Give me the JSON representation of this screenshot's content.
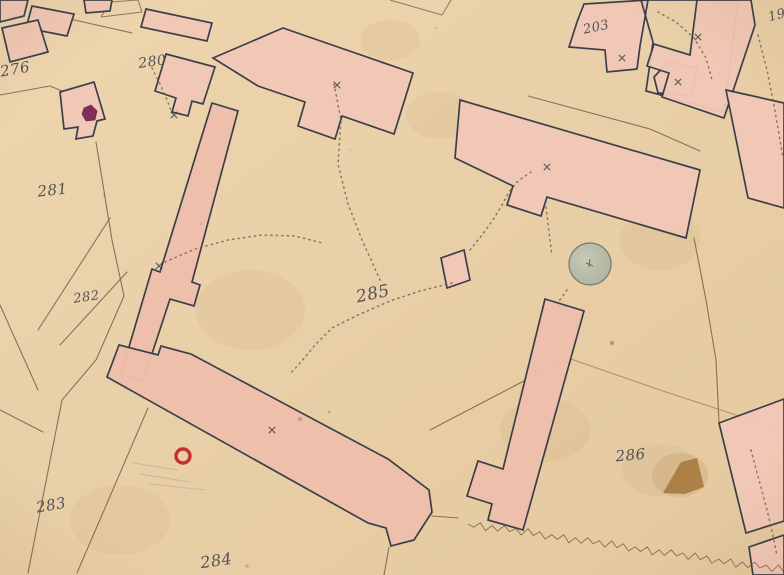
{
  "map": {
    "colors": {
      "paper": "#e9cfa7",
      "paper_light": "#eed7b2",
      "paper_dark": "#e3c69c",
      "building_fill": "#f2c8b6",
      "building_fill_alt": "#efc0ad",
      "building_stroke": "#343a47",
      "line": "#7b5f45",
      "red_line": "#bb7a66",
      "dotted": "#6f5741",
      "ink": "#43454e",
      "ring_red": "#c32222",
      "blob_crimson": "#7d2752",
      "well_fill": "#b9bdac",
      "well_stroke": "#70756a",
      "stain_brown": "#a5763a"
    },
    "region_labels": [
      {
        "name": "parcel-276",
        "text": "276",
        "x": 16,
        "y": 74,
        "size": 15,
        "rotate": -10
      },
      {
        "name": "parcel-280",
        "text": "280",
        "x": 153,
        "y": 66,
        "size": 14,
        "rotate": -8
      },
      {
        "name": "parcel-281",
        "text": "281",
        "x": 53,
        "y": 195,
        "size": 15,
        "rotate": -6
      },
      {
        "name": "parcel-282",
        "text": "282",
        "x": 87,
        "y": 301,
        "size": 13,
        "rotate": -8
      },
      {
        "name": "parcel-283",
        "text": "283",
        "x": 52,
        "y": 510,
        "size": 15,
        "rotate": -10
      },
      {
        "name": "parcel-284",
        "text": "284",
        "x": 217,
        "y": 566,
        "size": 16,
        "rotate": -8
      },
      {
        "name": "parcel-285",
        "text": "285",
        "x": 374,
        "y": 299,
        "size": 17,
        "rotate": -12
      },
      {
        "name": "parcel-286",
        "text": "286",
        "x": 631,
        "y": 460,
        "size": 15,
        "rotate": -5
      },
      {
        "name": "parcel-203",
        "text": "203",
        "x": 597,
        "y": 31,
        "size": 13,
        "rotate": -12
      },
      {
        "name": "parcel-19",
        "text": "19",
        "x": 778,
        "y": 19,
        "size": 13,
        "rotate": -15
      }
    ],
    "buildings": [
      {
        "name": "building-topleft-a",
        "points": "0,0 28,0 24,16 0,22"
      },
      {
        "name": "building-topleft-b",
        "points": "32,6 74,14 67,36 26,28"
      },
      {
        "name": "building-topleft-c",
        "points": "2,28 38,20 48,52 10,62"
      },
      {
        "name": "building-topleft-d",
        "points": "84,0 112,0 110,11 86,13"
      },
      {
        "name": "building-topleft-e",
        "points": "146,9 212,23 207,41 141,27"
      },
      {
        "name": "building-280",
        "points": "166,54 215,67 203,104 192,101 188,116 172,112 176,98 155,91"
      },
      {
        "name": "building-west-small",
        "points": "60,92 94,82 105,119 97,121 93,136 76,139 78,127 64,129"
      },
      {
        "name": "building-strip-west",
        "points": "212,103 238,111 192,282 200,285 194,306 170,299 143,381 121,374 152,269 160,272",
        "fill": "alt"
      },
      {
        "name": "building-top-center",
        "points": "213,58 283,28 413,73 394,134 342,116 335,139 298,126 305,102 258,86"
      },
      {
        "name": "building-north-row",
        "points": "460,100 700,170 686,238 652,228 547,197 541,216 507,205 513,186 455,158"
      },
      {
        "name": "building-203",
        "points": "584,4 648,0 640,46 637,69 607,72 605,50 569,47 577,22"
      },
      {
        "name": "building-court-outline",
        "points": "641,0 738,0 724,112 646,91 653,42",
        "fill": "none"
      },
      {
        "name": "building-l-piece",
        "points": "654,77 668,62 697,68 692,96 658,93"
      },
      {
        "name": "building-northeast-tall",
        "points": "697,0 751,0 755,25 724,118 662,97 669,73 647,66 654,44 690,55"
      },
      {
        "name": "building-east-row",
        "points": "726,90 784,103 784,208 748,198"
      },
      {
        "name": "building-small-square",
        "points": "441,258 464,250 470,280 447,288"
      },
      {
        "name": "building-strip-south",
        "points": "545,299 584,311 523,530 488,520 492,504 467,496 478,461 503,469",
        "fill": "alt"
      },
      {
        "name": "building-long-south",
        "points": "119,345 158,355 161,346 191,354 388,459 429,490 432,512 414,540 391,546 386,528 368,523 107,377",
        "fill": "alt"
      },
      {
        "name": "building-southeast",
        "points": "719,423 784,399 784,521 746,533"
      },
      {
        "name": "building-corner-southeast",
        "points": "749,547 784,535 784,575 753,575"
      }
    ],
    "outline_shapes": [
      {
        "name": "pencil-outline-north",
        "points": "390,0 442,15 451,0"
      },
      {
        "name": "pencil-outline-topleft",
        "points": "101,17 110,2 138,0 142,12 101,17"
      }
    ],
    "parcel_lines": [
      {
        "points": "110,218 38,330"
      },
      {
        "points": "127,272 60,345"
      },
      {
        "points": "96,142 112,240 124,296 96,360 62,400 28,573"
      },
      {
        "points": "148,408 77,573"
      },
      {
        "points": "0,305 38,390"
      },
      {
        "points": "0,410 43,432"
      },
      {
        "points": "432,516 458,518"
      },
      {
        "points": "389,547 384,575"
      },
      {
        "points": "694,238 706,300 716,360 719,422"
      },
      {
        "points": "528,96 650,129 700,151"
      },
      {
        "points": "568,358 430,430"
      },
      {
        "points": "0,95 50,86 62,91"
      },
      {
        "points": "70,19 132,33"
      },
      {
        "points": "568,358 660,390 745,418 784,430",
        "color": "#bb7a66"
      }
    ],
    "dotted_paths": [
      {
        "points": "334,84 341,120 338,164 348,204 362,240 372,262 380,280"
      },
      {
        "points": "452,283 420,291 390,301 358,315 332,328 315,345 301,362 289,375"
      },
      {
        "points": "470,250 482,235 493,220 502,205 509,192 518,181 531,172"
      },
      {
        "points": "546,207 549,232 552,256"
      },
      {
        "points": "567,290 559,301"
      },
      {
        "points": "152,68 160,84 167,100 172,113"
      },
      {
        "points": "658,12 676,22 694,38 706,58 712,80"
      },
      {
        "points": "758,35 767,70 774,105 780,140 783,158"
      },
      {
        "points": "751,450 759,480 767,510 773,535 777,556"
      },
      {
        "points": "165,262 195,249 228,240 262,235 295,236 322,243"
      }
    ],
    "crosses": [
      [
        547,
        167
      ],
      [
        622,
        58
      ],
      [
        337,
        85
      ],
      [
        272,
        430
      ],
      [
        159,
        266
      ],
      [
        174,
        115
      ],
      [
        678,
        82
      ],
      [
        698,
        37
      ]
    ],
    "features": {
      "well": {
        "cx": 590,
        "cy": 264,
        "r": 21
      },
      "red_ring": {
        "cx": 183,
        "cy": 456,
        "r": 7
      },
      "crimson_blob": {
        "points": "84,108 91,105 97,111 95,120 86,121 82,114"
      },
      "stain_halo": {
        "cx": 680,
        "cy": 475,
        "rx": 28,
        "ry": 22
      },
      "stain_triangle": {
        "points": "663,493 681,462 697,458 704,487 685,494"
      },
      "smudge_286": {
        "cx": 660,
        "cy": 470,
        "rx": 38,
        "ry": 26
      },
      "zigzag": {
        "x1": 468,
        "y1": 524,
        "x2": 784,
        "y2": 570
      },
      "pencil_hatches": [
        "133,463 178,470",
        "140,474 190,482",
        "150,484 205,490"
      ],
      "speckles": [
        [
          300,
          419,
          2,
          0.35
        ],
        [
          329,
          412,
          1.5,
          0.3
        ],
        [
          612,
          343,
          2.2,
          0.45
        ],
        [
          247,
          566,
          1.8,
          0.3
        ],
        [
          104,
          195,
          1.5,
          0.25
        ],
        [
          350,
          150,
          1.3,
          0.15
        ],
        [
          436,
          28,
          1.4,
          0.18
        ],
        [
          201,
          224,
          1.2,
          0.2
        ]
      ],
      "soft_stains": [
        [
          440,
          115,
          34,
          24
        ],
        [
          250,
          310,
          55,
          40
        ],
        [
          545,
          430,
          45,
          32
        ],
        [
          660,
          240,
          40,
          30
        ],
        [
          120,
          520,
          50,
          35
        ],
        [
          390,
          40,
          30,
          20
        ]
      ]
    }
  }
}
